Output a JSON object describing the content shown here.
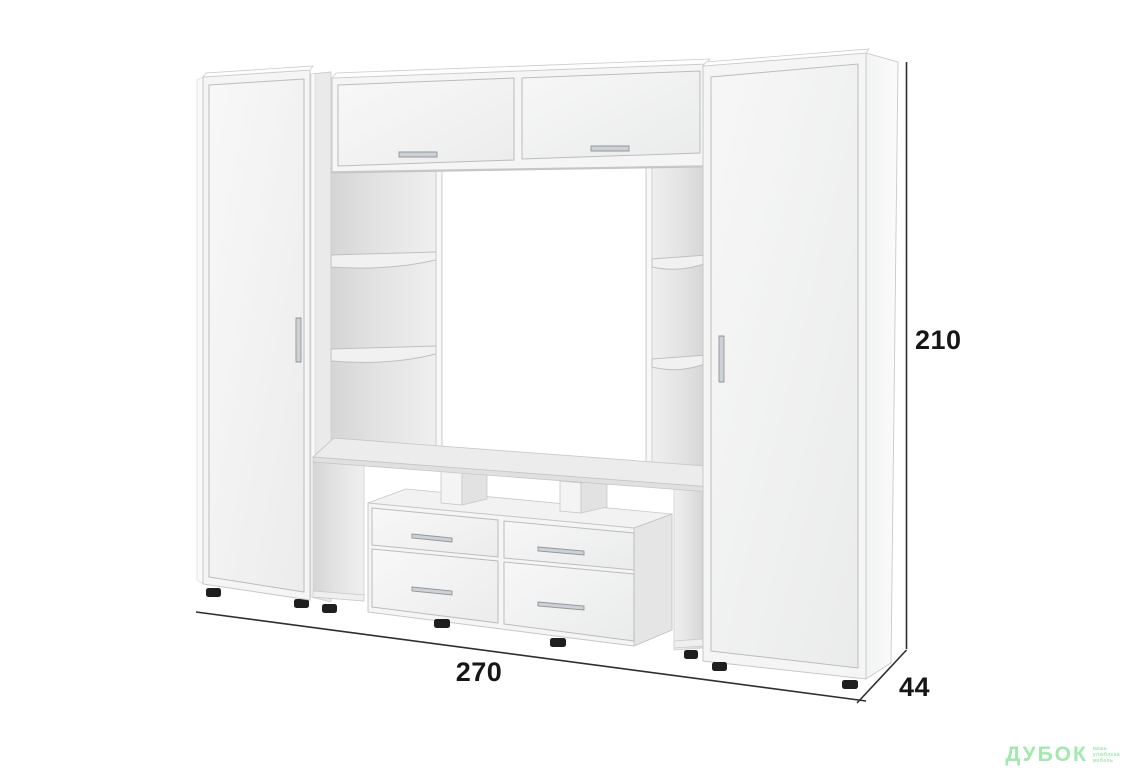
{
  "dimensions": {
    "height": "210",
    "width": "270",
    "depth": "44"
  },
  "watermark": {
    "brand": "ДУБОК",
    "tagline_lines": [
      "ваша",
      "улюблена",
      "мебель"
    ]
  },
  "palette": {
    "background": "#ffffff",
    "face": "#f5f5f5",
    "edge": "#c7c7c7",
    "interior_dark": "#d6d6d6",
    "interior_light": "#efefef",
    "feet": "#1e1e1e",
    "handle": "#ccd1d5",
    "dimension_line": "#2e2e2e",
    "label_text": "#161616",
    "watermark_green": "#a2e8af"
  }
}
